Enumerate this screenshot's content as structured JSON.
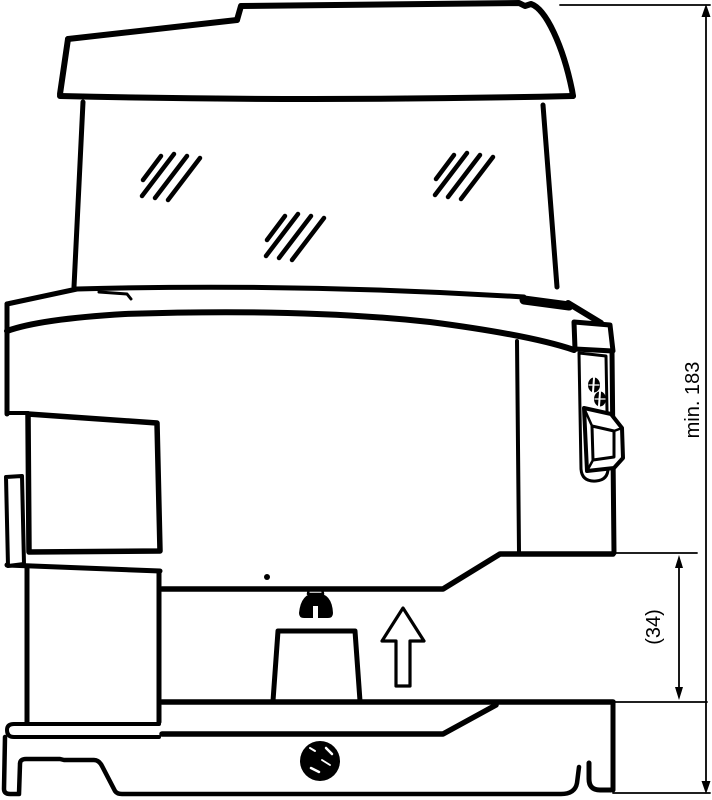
{
  "diagram": {
    "description": "Technical side-view line drawing of an appliance showing required height clearance",
    "background_color": "#ffffff",
    "line_color": "#000000",
    "dimensions": {
      "overall_height": {
        "label": "min. 183"
      },
      "recess_height": {
        "label": "(34)"
      }
    },
    "icons": {
      "lift_direction_arrow": "up",
      "glass_reflection_marks": 3
    }
  }
}
